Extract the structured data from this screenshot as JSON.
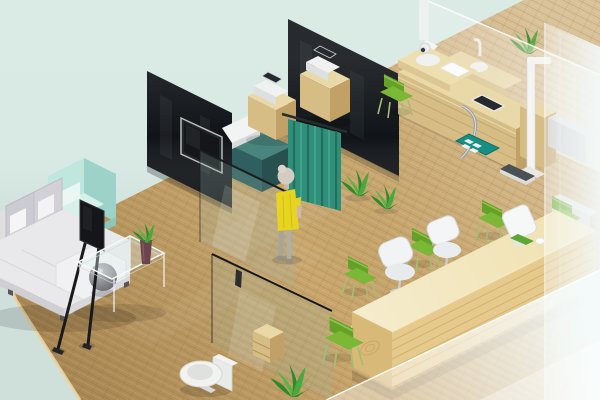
{
  "scene": {
    "type": "3d-isometric-interior-render",
    "description": "Isometric 3D rendering of a clinic interior: lounge with sofa and TV, exam rooms with black glass partition walls and teal privacy curtain, restroom with toilet behind glass, wooden reception counter with waiting chairs, frosted glass facade on the right",
    "colors": {
      "background": "#d9eae5",
      "floor": "#c8a66c",
      "wall_black": "#101317",
      "glass_tint": "#9db8ac",
      "wood_top": "#e9d8a8",
      "wood_front": "#d6bd85",
      "wood_side": "#c2a166",
      "counter_top": "#f0e2b2",
      "counter_front": "#e5c98d",
      "counter_side": "#d9b978",
      "curtain": "#2f8f7a",
      "curtain_dark": "#1f6b58",
      "curtain_light": "#45a68c",
      "chair_green": "#64a127",
      "chair_green_light": "#7bb836",
      "plant_green": "#2f8a2c",
      "plant_light": "#56b544",
      "sofa_white": "#e9e9eb",
      "armchair_mint": "#bfe7de",
      "armchair_shade": "#9dd2c8",
      "dress_yellow": "#e8d41f",
      "skin": "#c9b9a6",
      "hair": "#d2ccc2",
      "toilet": "#f2f2f0",
      "teal_cabinet": "#2f5f5e",
      "teal_mat": "#178f85",
      "device_white": "#f0f2f2",
      "screen_dark": "#26292e",
      "tv_black": "#141619",
      "chrome": "#9aa0a6",
      "stadiometer": "#f4f4f2",
      "scale_dark": "#4b5054"
    },
    "objects": [
      {
        "id": "sofa",
        "label": "L-shaped lounge sofa"
      },
      {
        "id": "armchair",
        "label": "Mint armchair"
      },
      {
        "id": "tv-easel",
        "label": "TV on easel stand"
      },
      {
        "id": "coffee-table",
        "label": "Glass coffee table"
      },
      {
        "id": "partition-walls",
        "label": "Black glass partition walls"
      },
      {
        "id": "wall-tv",
        "label": "Wall-mounted TV"
      },
      {
        "id": "cabinets",
        "label": "Wooden cabinets with white devices"
      },
      {
        "id": "curtain",
        "label": "Teal privacy curtain"
      },
      {
        "id": "person",
        "label": "Standing person in yellow dress"
      },
      {
        "id": "plants",
        "label": "Potted green plants"
      },
      {
        "id": "toilet",
        "label": "Toilet"
      },
      {
        "id": "glass-partitions",
        "label": "Glass partitions"
      },
      {
        "id": "exam-desk",
        "label": "Wooden exam desk with tablet"
      },
      {
        "id": "stadiometer",
        "label": "Height measuring rod"
      },
      {
        "id": "scale",
        "label": "Weighing scale"
      },
      {
        "id": "floor-mat",
        "label": "Teal floor mat"
      },
      {
        "id": "sink",
        "label": "Sink counter"
      },
      {
        "id": "reception-counter",
        "label": "Wooden reception counter"
      },
      {
        "id": "reception-monitor",
        "label": "White terminal on counter"
      },
      {
        "id": "office-chairs",
        "label": "White office chairs"
      },
      {
        "id": "green-chairs",
        "label": "Green visitor chairs"
      },
      {
        "id": "frosted-glass",
        "label": "Frosted glass facade"
      }
    ]
  }
}
